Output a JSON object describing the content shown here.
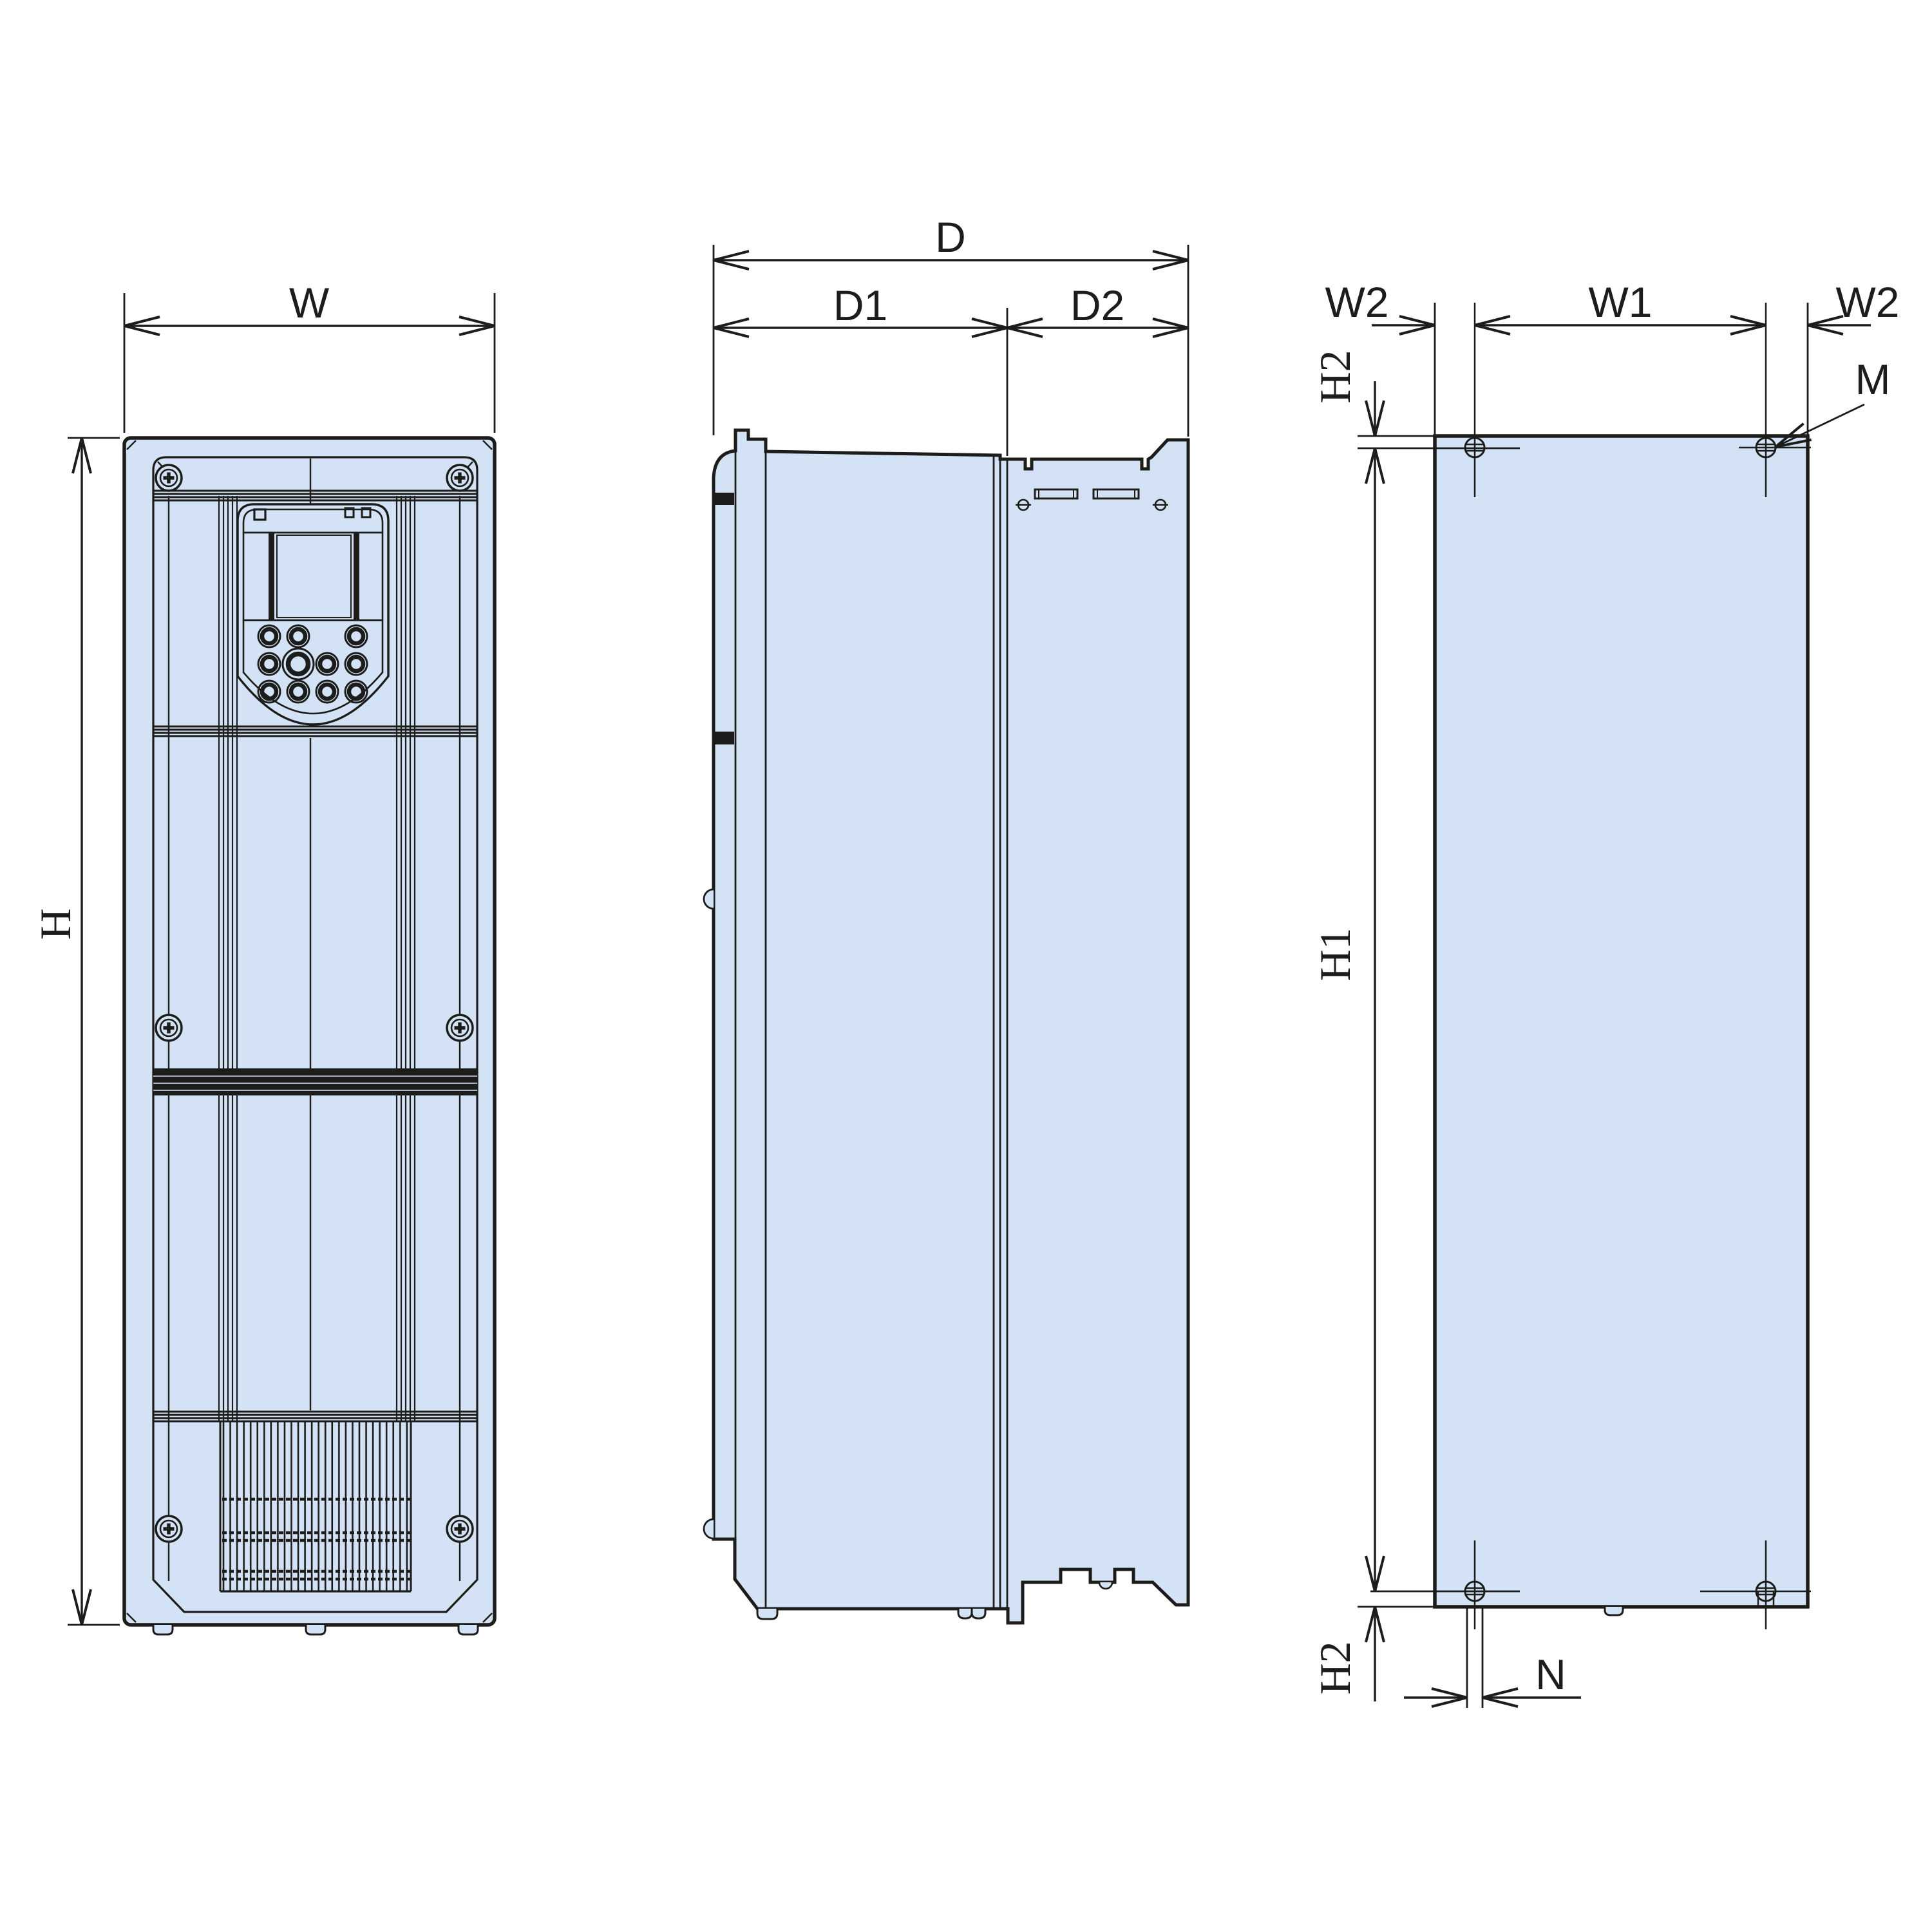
{
  "diagram": {
    "title": "inverter-outline-dimension-drawing",
    "views": [
      {
        "id": "front-view",
        "name": "front view"
      },
      {
        "id": "side-view",
        "name": "side view"
      },
      {
        "id": "back-view",
        "name": "rear mounting view"
      }
    ],
    "labels": {
      "w": "W",
      "h": "H",
      "d": "D",
      "d1": "D1",
      "d2": "D2",
      "w2_left": "W2",
      "w1": "W1",
      "w2_right": "W2",
      "h2_top": "H2",
      "h1": "H1",
      "h2_bottom": "H2",
      "m": "M",
      "n": "N"
    },
    "colors": {
      "body_fill": "#d3e2f4",
      "line": "#1c1c1a",
      "background": "#ffffff"
    }
  }
}
